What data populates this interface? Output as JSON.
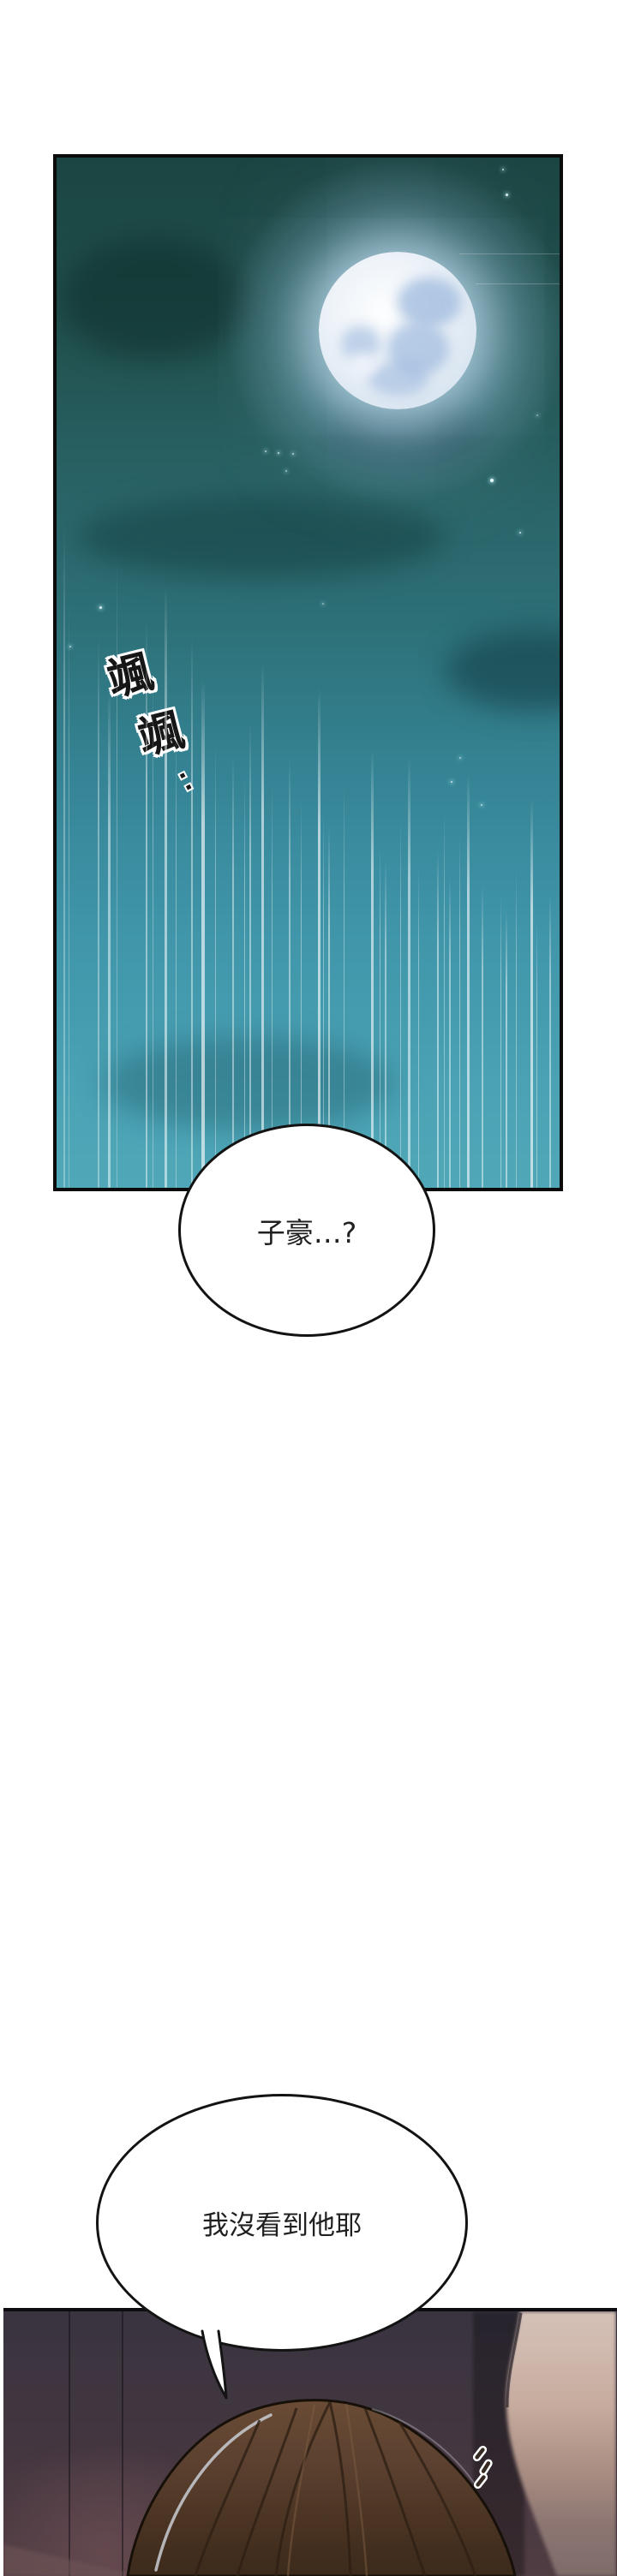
{
  "comic": {
    "sfx": {
      "char1": "颯",
      "char2": "颯",
      "trail": "··"
    },
    "bubble1": {
      "text": "子豪…?"
    },
    "bubble2": {
      "text": "我沒看到他耶"
    }
  },
  "colors": {
    "page_bg": "#ffffff",
    "panel_border": "#0b0b0b",
    "sky_top": "#1b4543",
    "sky_bottom": "#4fa7b7",
    "moon_core": "#fdfefe",
    "moon_shade": "#9db9dd",
    "streak_light": "#ffffff",
    "wall_top": "#393440",
    "wall_bottom": "#503d43",
    "hair_brown": "#5c4130",
    "hair_rim_light": "#c9cdd4",
    "foreground_skin": "#c7ac9f",
    "bubble_fill": "#ffffff",
    "bubble_stroke": "#131313",
    "dialogue_text": "#202020"
  }
}
